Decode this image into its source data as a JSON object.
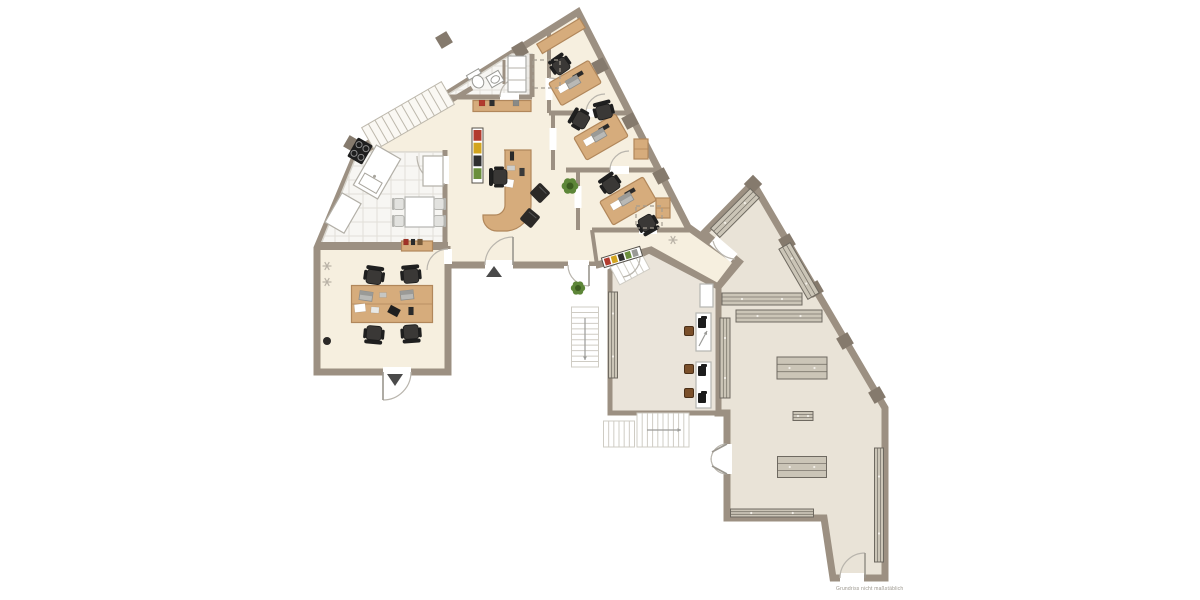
{
  "meta": {
    "title": "office-floor-plan",
    "watermark": "Grundriss nicht maßstäblich",
    "canvas": {
      "w": 1200,
      "h": 600,
      "bg": "#ffffff"
    }
  },
  "palette": {
    "wall": "#9c9082",
    "wallDark": "#857a6d",
    "cream": "#f6efdf",
    "grey": "#e9e3d7",
    "grey2": "#eae4da",
    "tile": "#f7f6f3",
    "tileLine": "#e2dfd8",
    "tileStroke": "#d8d5cd",
    "wood": "#d6ac7c",
    "woodDark": "#b1875b",
    "shelf": "#cbc5b7",
    "shelfLine": "#6e6960",
    "shelfDot": "#f2efe8",
    "chair": "#2b2927",
    "chairSeat": "#3a3836",
    "kchair": "#e2e2df",
    "kchairLine": "#b5b5b1",
    "stool": "#7a4f2a",
    "stoolLine": "#4a2f18",
    "white": "#ffffff",
    "paper": "#ffffff",
    "stairInt": "#faf8f3",
    "stairIntLine": "#bdb8ac",
    "stairExt": "#ffffff",
    "stairExtLine": "#cfccc4",
    "doorArc": "#b9b5ad",
    "leaf": "#9a968e",
    "dash": "#a39c90",
    "dark": "#4a4a4a",
    "green": "#5d8638",
    "greenDark": "#3c5c20",
    "bookColors": [
      "#b23b2e",
      "#d2a41f",
      "#2f2f2f",
      "#6b8f3c",
      "#9a9a96"
    ]
  },
  "plan": {
    "floors": [
      {
        "name": "left-building-floor",
        "fill": "cream",
        "lw": 7,
        "points": [
          [
            317,
            372
          ],
          [
            317,
            248
          ],
          [
            358,
            150
          ],
          [
            578,
            12
          ],
          [
            688,
            227
          ],
          [
            737,
            262
          ],
          [
            718,
            287
          ],
          [
            651,
            250
          ],
          [
            597,
            265
          ],
          [
            448,
            265
          ],
          [
            448,
            372
          ]
        ]
      },
      {
        "name": "right-hall-floor",
        "fill": "grey",
        "lw": 7,
        "points": [
          [
            753,
            183
          ],
          [
            885,
            408
          ],
          [
            885,
            578
          ],
          [
            833,
            578
          ],
          [
            824,
            518
          ],
          [
            727,
            518
          ],
          [
            727,
            413
          ],
          [
            718,
            413
          ],
          [
            718,
            287
          ],
          [
            739,
            262
          ],
          [
            704,
            233
          ]
        ]
      },
      {
        "name": "workshop-room-floor",
        "fill": "grey2",
        "lw": 5,
        "points": [
          [
            610,
            271
          ],
          [
            649,
            251
          ],
          [
            718,
            287
          ],
          [
            718,
            413
          ],
          [
            610,
            413
          ]
        ]
      }
    ],
    "tiles": [
      {
        "name": "kitchen-tiles",
        "points": [
          [
            321,
            244
          ],
          [
            358,
            152
          ],
          [
            445,
            152
          ],
          [
            445,
            244
          ]
        ],
        "grid": 14
      },
      {
        "name": "bathroom-tiles",
        "points": [
          [
            444,
            97
          ],
          [
            512,
            54
          ],
          [
            532,
            54
          ],
          [
            532,
            97
          ]
        ],
        "grid": 12
      }
    ],
    "misc_white": [
      {
        "name": "alcove-floor",
        "x": 564,
        "y": 266,
        "w": 32,
        "h": 33
      }
    ],
    "walls": [
      [
        320,
        246,
        448,
        246,
        8
      ],
      [
        445,
        150,
        445,
        246,
        5
      ],
      [
        354,
        158,
        472,
        88,
        5
      ],
      [
        444,
        97,
        532,
        97,
        5
      ],
      [
        532,
        54,
        532,
        97,
        5
      ],
      [
        504,
        60,
        504,
        84,
        3
      ],
      [
        549,
        32,
        549,
        113,
        4
      ],
      [
        549,
        113,
        627,
        113,
        5
      ],
      [
        553,
        113,
        553,
        170,
        4
      ],
      [
        566,
        170,
        658,
        170,
        5
      ],
      [
        578,
        170,
        578,
        230,
        4
      ],
      [
        592,
        230,
        690,
        230,
        5
      ],
      [
        592,
        230,
        597,
        265,
        4
      ],
      [
        448,
        246,
        448,
        372,
        5
      ],
      [
        718,
        287,
        718,
        413,
        5
      ],
      [
        739,
        262,
        718,
        287,
        5
      ],
      [
        651,
        250,
        718,
        287,
        5
      ]
    ],
    "gaps": [
      [
        383,
        372,
        411,
        372,
        10
      ],
      [
        485,
        265,
        513,
        265,
        10
      ],
      [
        568,
        265,
        589,
        265,
        10
      ],
      [
        445,
        156,
        445,
        184,
        8
      ],
      [
        500,
        97,
        519,
        97,
        8
      ],
      [
        586,
        113,
        605,
        113,
        8
      ],
      [
        610,
        170,
        629,
        170,
        8
      ],
      [
        639,
        230,
        657,
        230,
        8
      ],
      [
        448,
        249,
        448,
        264,
        8
      ],
      [
        549,
        78,
        549,
        100,
        7
      ],
      [
        553,
        128,
        553,
        150,
        7
      ],
      [
        578,
        186,
        578,
        208,
        7
      ],
      [
        713,
        240,
        734,
        258,
        11
      ],
      [
        621,
        266,
        640,
        257,
        9
      ],
      [
        727,
        444,
        727,
        474,
        10
      ],
      [
        840,
        578,
        864,
        578,
        10
      ]
    ],
    "blocks": {
      "size": 13,
      "list": [
        [
          352,
          144,
          -60
        ],
        [
          444,
          40,
          -31
        ],
        [
          520,
          50,
          -31
        ],
        [
          600,
          66,
          62
        ],
        [
          630,
          121,
          62
        ],
        [
          661,
          176,
          62
        ],
        [
          753,
          184,
          -45
        ],
        [
          787,
          242,
          60
        ],
        [
          815,
          289,
          60
        ],
        [
          845,
          341,
          60
        ],
        [
          877,
          395,
          60
        ]
      ]
    },
    "stairs": [
      {
        "name": "interior-staircase",
        "cx": 408,
        "cy": 116,
        "len": 92,
        "wid": 26,
        "rot": -30,
        "n": 12,
        "ext": false
      },
      {
        "name": "workshop-steps",
        "cx": 630,
        "cy": 268,
        "len": 34,
        "wid": 20,
        "rot": -28,
        "n": 5,
        "ext": true
      },
      {
        "name": "exterior-stair-west",
        "cx": 585,
        "cy": 337,
        "len": 60,
        "wid": 27,
        "rot": 90,
        "n": 11,
        "ext": true
      },
      {
        "name": "exterior-stair-south",
        "cx": 663,
        "cy": 430,
        "len": 52,
        "wid": 34,
        "rot": 0,
        "n": 10,
        "ext": true
      },
      {
        "name": "exterior-stair-south-small",
        "cx": 619,
        "cy": 434,
        "len": 31,
        "wid": 26,
        "rot": 0,
        "n": 6,
        "ext": true
      }
    ],
    "arcs": [
      {
        "d": "M485,265 A28,28 0 0 1 513,237",
        "leaf": [
          513,
          265,
          513,
          237
        ]
      },
      {
        "d": "M568,265 A21,21 0 0 0 589,286",
        "leaf": [
          589,
          265,
          589,
          286
        ]
      },
      {
        "d": "M445,184 A28,28 0 0 1 417,156"
      },
      {
        "d": "M500,97 A19,19 0 0 1 519,78"
      },
      {
        "d": "M549,78 A22,22 0 0 1 571,100"
      },
      {
        "d": "M586,113 A19,19 0 0 1 605,94"
      },
      {
        "d": "M610,170 A19,19 0 0 1 629,151"
      },
      {
        "d": "M448,249 A21,21 0 0 0 427,270"
      },
      {
        "d": "M411,372 A28,28 0 0 1 383,400",
        "leaf": [
          383,
          372,
          383,
          400
        ]
      },
      {
        "d": "M713,241 A24,24 0 0 0 735,259"
      },
      {
        "d": "M640,257 A20,20 0 0 1 623,277"
      },
      {
        "d": "M727,444 A16,16 0 0 0 711,460",
        "leaf": [
          727,
          444,
          712,
          452
        ]
      },
      {
        "d": "M727,474 A16,16 0 0 1 711,458",
        "leaf": [
          727,
          474,
          712,
          466
        ]
      },
      {
        "d": "M840,578 A25,25 0 0 1 865,553",
        "leaf": [
          865,
          578,
          865,
          553
        ]
      }
    ],
    "triangles": [
      [
        [
          387,
          374
        ],
        [
          403,
          374
        ],
        [
          395,
          386
        ]
      ],
      [
        [
          486,
          277
        ],
        [
          502,
          277
        ],
        [
          494,
          266
        ]
      ]
    ],
    "shelves": [
      [
        735,
        213,
        56,
        13,
        -45
      ],
      [
        799,
        271,
        58,
        13,
        60
      ],
      [
        762,
        299,
        80,
        12,
        0
      ],
      [
        779,
        316,
        86,
        12,
        0
      ],
      [
        725,
        358,
        80,
        10,
        90
      ],
      [
        613,
        335,
        86,
        9,
        90
      ],
      [
        802,
        368,
        50,
        22,
        0
      ],
      [
        803,
        416,
        20,
        9,
        0
      ],
      [
        802,
        467,
        49,
        21,
        0
      ],
      [
        772,
        513,
        83,
        8,
        0
      ],
      [
        879,
        505,
        114,
        9,
        90
      ]
    ],
    "desks": [
      [
        575,
        83,
        46,
        26,
        -30
      ],
      [
        601,
        137,
        48,
        26,
        -30
      ],
      [
        628,
        201,
        50,
        27,
        -30
      ]
    ],
    "reception_desk_path": "M504,150 H531 V205 A26,26 0 0 1 505,231 H497 A14,14 0 0 1 483,217 V215 H495 A10,10 0 0 0 505,205 V150 Z",
    "wood_rects": [
      {
        "cx": 392,
        "cy": 304,
        "w": 81,
        "h": 37,
        "rot": 0,
        "seam": true,
        "name": "team-table"
      },
      {
        "cx": 502,
        "cy": 106,
        "w": 58,
        "h": 11,
        "rot": 0,
        "seam": false,
        "name": "hall-sideboard"
      },
      {
        "cx": 417,
        "cy": 246,
        "w": 31,
        "h": 10,
        "rot": 0,
        "seam": false,
        "name": "kitchen-sideboard"
      },
      {
        "cx": 561,
        "cy": 36,
        "w": 50,
        "h": 11,
        "rot": -31,
        "seam": false,
        "name": "office1-sideboard"
      },
      {
        "cx": 641,
        "cy": 149,
        "w": 14,
        "h": 20,
        "rot": 0,
        "seam": true,
        "name": "office2-cabinet"
      },
      {
        "cx": 663,
        "cy": 208,
        "w": 14,
        "h": 20,
        "rot": 0,
        "seam": true,
        "name": "office3-cabinet"
      }
    ],
    "tables_white": [
      [
        405,
        197,
        29,
        30
      ],
      [
        696,
        313,
        15,
        38
      ],
      [
        696,
        362,
        15,
        46
      ],
      [
        700,
        284,
        13,
        23
      ]
    ],
    "ochairs": [
      [
        374,
        277,
        8
      ],
      [
        411,
        276,
        -5
      ],
      [
        374,
        333,
        185
      ],
      [
        411,
        332,
        176
      ],
      [
        500,
        177,
        -90
      ],
      [
        561,
        66,
        -35
      ],
      [
        581,
        120,
        -60
      ],
      [
        604,
        112,
        -15
      ],
      [
        611,
        185,
        -35
      ],
      [
        647,
        223,
        150
      ]
    ],
    "cchairs": [
      [
        540,
        193,
        45
      ],
      [
        530,
        218,
        40
      ]
    ],
    "kchairs": [
      [
        399,
        204,
        -90
      ],
      [
        399,
        221,
        -90
      ],
      [
        439,
        204,
        90
      ],
      [
        439,
        221,
        90
      ]
    ],
    "stools": [
      [
        689,
        331
      ],
      [
        689,
        369
      ],
      [
        689,
        393
      ]
    ],
    "laptops": [
      [
        573,
        82,
        -30
      ],
      [
        599,
        135,
        -30
      ],
      [
        626,
        199,
        -30
      ],
      [
        366,
        296,
        8
      ],
      [
        407,
        295,
        -6
      ]
    ],
    "machines": [
      [
        702,
        323
      ],
      [
        702,
        371
      ],
      [
        702,
        398
      ]
    ],
    "plants": [
      [
        570,
        186,
        7
      ],
      [
        578,
        288,
        6
      ]
    ],
    "books_v": [
      {
        "x": 472,
        "y": 128,
        "w": 11,
        "h": 55
      }
    ],
    "books_r": [
      {
        "cx": 622,
        "cy": 257,
        "w": 40,
        "h": 10,
        "rot": -17
      }
    ],
    "stove": {
      "cx": 360,
      "cy": 151,
      "w": 22,
      "h": 17,
      "rot": -60
    },
    "counters": [
      {
        "cx": 377,
        "cy": 172,
        "w": 46,
        "h": 28,
        "rot": -60,
        "sink": true
      },
      {
        "cx": 343,
        "cy": 213,
        "w": 34,
        "h": 22,
        "rot": -60,
        "sink": false
      },
      {
        "cx": 433,
        "cy": 171,
        "w": 20,
        "h": 30,
        "rot": 0,
        "sink": false
      }
    ],
    "bath": {
      "toilet": {
        "cx": 477,
        "cy": 80,
        "rot": -30
      },
      "sink": {
        "cx": 495,
        "cy": 79,
        "rot": -30
      },
      "cabinet": {
        "x": 508,
        "y": 56,
        "w": 18,
        "h": 36
      }
    },
    "dashed": [
      [
        533,
        60,
        27,
        28
      ],
      [
        636,
        206,
        26,
        22
      ]
    ],
    "stars": [
      [
        327,
        266
      ],
      [
        327,
        282
      ],
      [
        673,
        240
      ]
    ],
    "dots": [
      [
        327,
        341,
        4
      ]
    ],
    "arrows": [
      [
        585,
        318,
        585,
        360
      ],
      [
        647,
        430,
        681,
        430
      ],
      [
        699,
        346,
        707,
        331
      ]
    ],
    "deskbits": [
      [
        512,
        156,
        4,
        9,
        0,
        "#2a2a2a"
      ],
      [
        511,
        168,
        8,
        5,
        0,
        "#cfcfcc"
      ],
      [
        508,
        183,
        11,
        8,
        10,
        "#ffffff"
      ],
      [
        522,
        172,
        5,
        8,
        0,
        "#3a3a3a"
      ],
      [
        360,
        308,
        11,
        8,
        -6,
        "#ffffff"
      ],
      [
        375,
        310,
        8,
        6,
        4,
        "#e8e8e5"
      ],
      [
        394,
        311,
        11,
        8,
        28,
        "#1f1f1f"
      ],
      [
        411,
        311,
        5,
        8,
        0,
        "#2a2a2a"
      ],
      [
        383,
        295,
        7,
        5,
        0,
        "#c6c6c2"
      ],
      [
        563,
        88,
        10,
        7,
        -30,
        "#ffffff"
      ],
      [
        589,
        141,
        10,
        7,
        -30,
        "#ffffff"
      ],
      [
        616,
        205,
        10,
        7,
        -30,
        "#ffffff"
      ],
      [
        578,
        75,
        11,
        4,
        -30,
        "#2a2a2a"
      ],
      [
        604,
        128,
        11,
        4,
        -30,
        "#2a2a2a"
      ],
      [
        630,
        192,
        11,
        4,
        -30,
        "#2a2a2a"
      ],
      [
        482,
        103,
        6,
        6,
        0,
        "#b23b2e"
      ],
      [
        492,
        103,
        5,
        6,
        0,
        "#2f2f2f"
      ],
      [
        516,
        103,
        6,
        6,
        0,
        "#8a8a86"
      ],
      [
        406,
        242,
        5,
        6,
        0,
        "#a03226"
      ],
      [
        413,
        242,
        4,
        6,
        0,
        "#2b2b2b"
      ],
      [
        420,
        242,
        5,
        6,
        0,
        "#7a5c3a"
      ]
    ]
  }
}
